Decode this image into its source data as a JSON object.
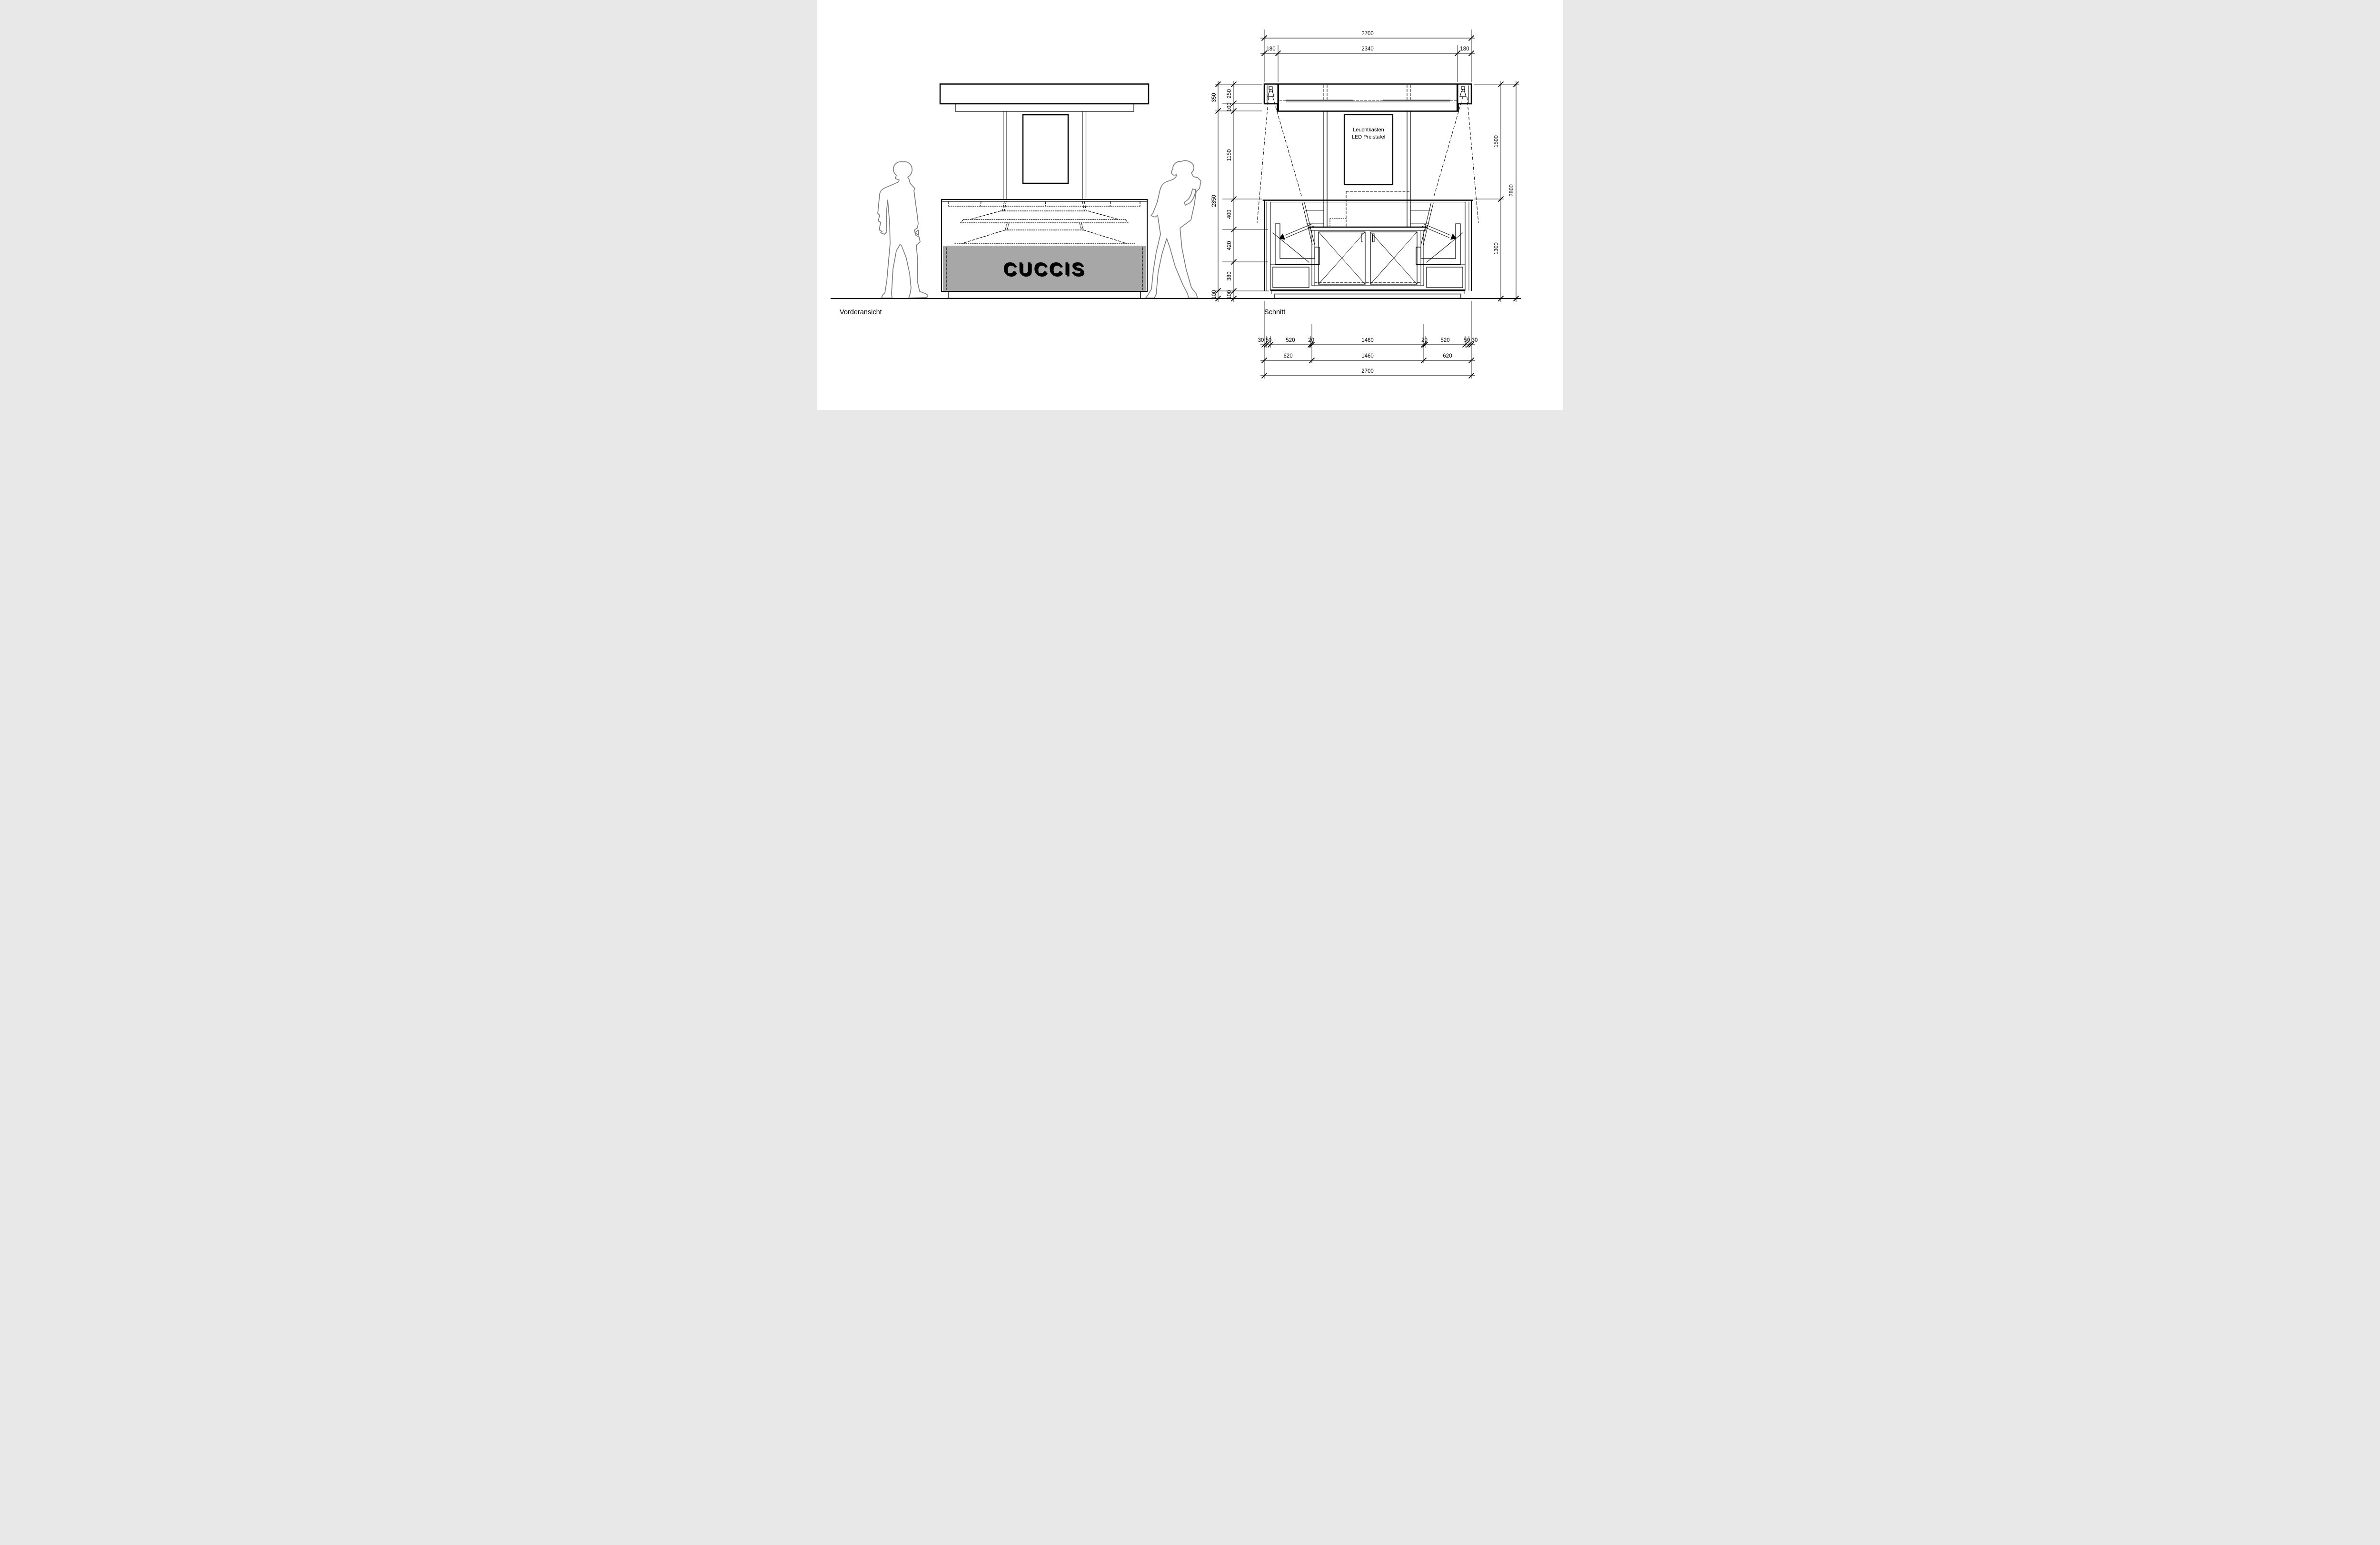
{
  "labels": {
    "front_view": "Vorderansicht",
    "section_view": "Schnitt"
  },
  "front": {
    "sign_text": "CUCCIS"
  },
  "section": {
    "annotation": {
      "line1": "Leuchtkasten",
      "line2": "LED Preistafel"
    }
  },
  "dims": {
    "top": {
      "overall": "2700",
      "left": "180",
      "middle": "2340",
      "right": "180"
    },
    "left_outer": [
      "350",
      "2350",
      "100"
    ],
    "left_inner": [
      "250",
      "100",
      "1150",
      "400",
      "420",
      "380",
      "100"
    ],
    "right_inner": [
      "1500",
      "1300"
    ],
    "right_outer": "2800",
    "bottom_row1": [
      "30",
      "50",
      "520",
      "20",
      "1460",
      "20",
      "520",
      "50",
      "30"
    ],
    "bottom_row2": [
      "620",
      "1460",
      "620"
    ],
    "bottom_row3": "2700"
  },
  "colors": {
    "canopy": "#b9b9b9",
    "sign_band": "#a7a7a7",
    "channel": "#c6c6c6",
    "plinth": "#b5b5b5"
  }
}
